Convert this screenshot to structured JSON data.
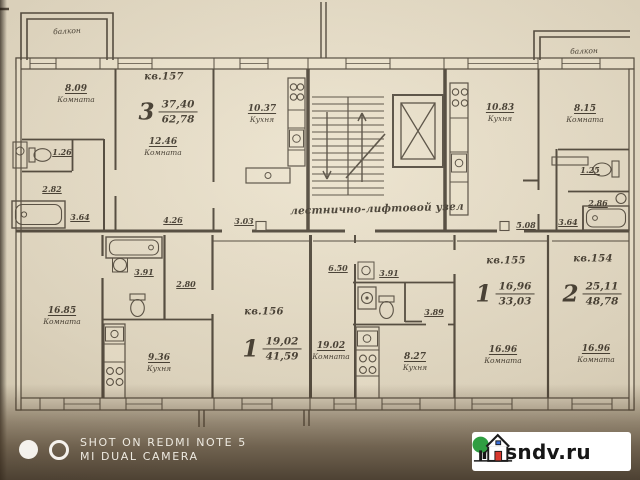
{
  "plan": {
    "balcony_left": "балкон",
    "balcony_right": "балкон",
    "stair_node_label": "лестнично-лифтовой узел",
    "apartments": {
      "a157": {
        "id": "кв.157",
        "rooms": "3",
        "living": "37,40",
        "total": "62,78"
      },
      "a156": {
        "id": "кв.156",
        "rooms": "1",
        "living": "19,02",
        "total": "41,59"
      },
      "a155": {
        "id": "кв.155",
        "rooms": "1",
        "living": "16,96",
        "total": "33,03"
      },
      "a154": {
        "id": "кв.154",
        "rooms": "2",
        "living": "25,11",
        "total": "48,78"
      }
    },
    "rooms": [
      {
        "area": "8.09",
        "name": "Комната"
      },
      {
        "area": "12.46",
        "name": "Комната"
      },
      {
        "area": "10.37",
        "name": "Кухня"
      },
      {
        "area": "10.83",
        "name": "Кухня"
      },
      {
        "area": "8.15",
        "name": "Комната"
      },
      {
        "area": "16.85",
        "name": "Комната"
      },
      {
        "area": "9.36",
        "name": "Кухня"
      },
      {
        "area": "19.02",
        "name": "Комната"
      },
      {
        "area": "8.27",
        "name": "Кухня"
      },
      {
        "area": "16.96",
        "name": "Комната"
      },
      {
        "area": "16.96",
        "name": "Комната"
      }
    ],
    "dimensions": [
      "1.26",
      "2.82",
      "3.64",
      "4.26",
      "3.03",
      "3.91",
      "2.80",
      "6.50",
      "3.91",
      "3.89",
      "5.08",
      "3.64",
      "1.25",
      "2.86"
    ]
  },
  "watermarks": {
    "camera_line1": "SHOT ON REDMI NOTE 5",
    "camera_line2": "MI DUAL CAMERA",
    "site": "rosndv.ru"
  },
  "colors": {
    "paper": "#e5dcc6",
    "line": "#4a4236",
    "badge_tree": "#2f9e41",
    "badge_door": "#d8382e"
  }
}
